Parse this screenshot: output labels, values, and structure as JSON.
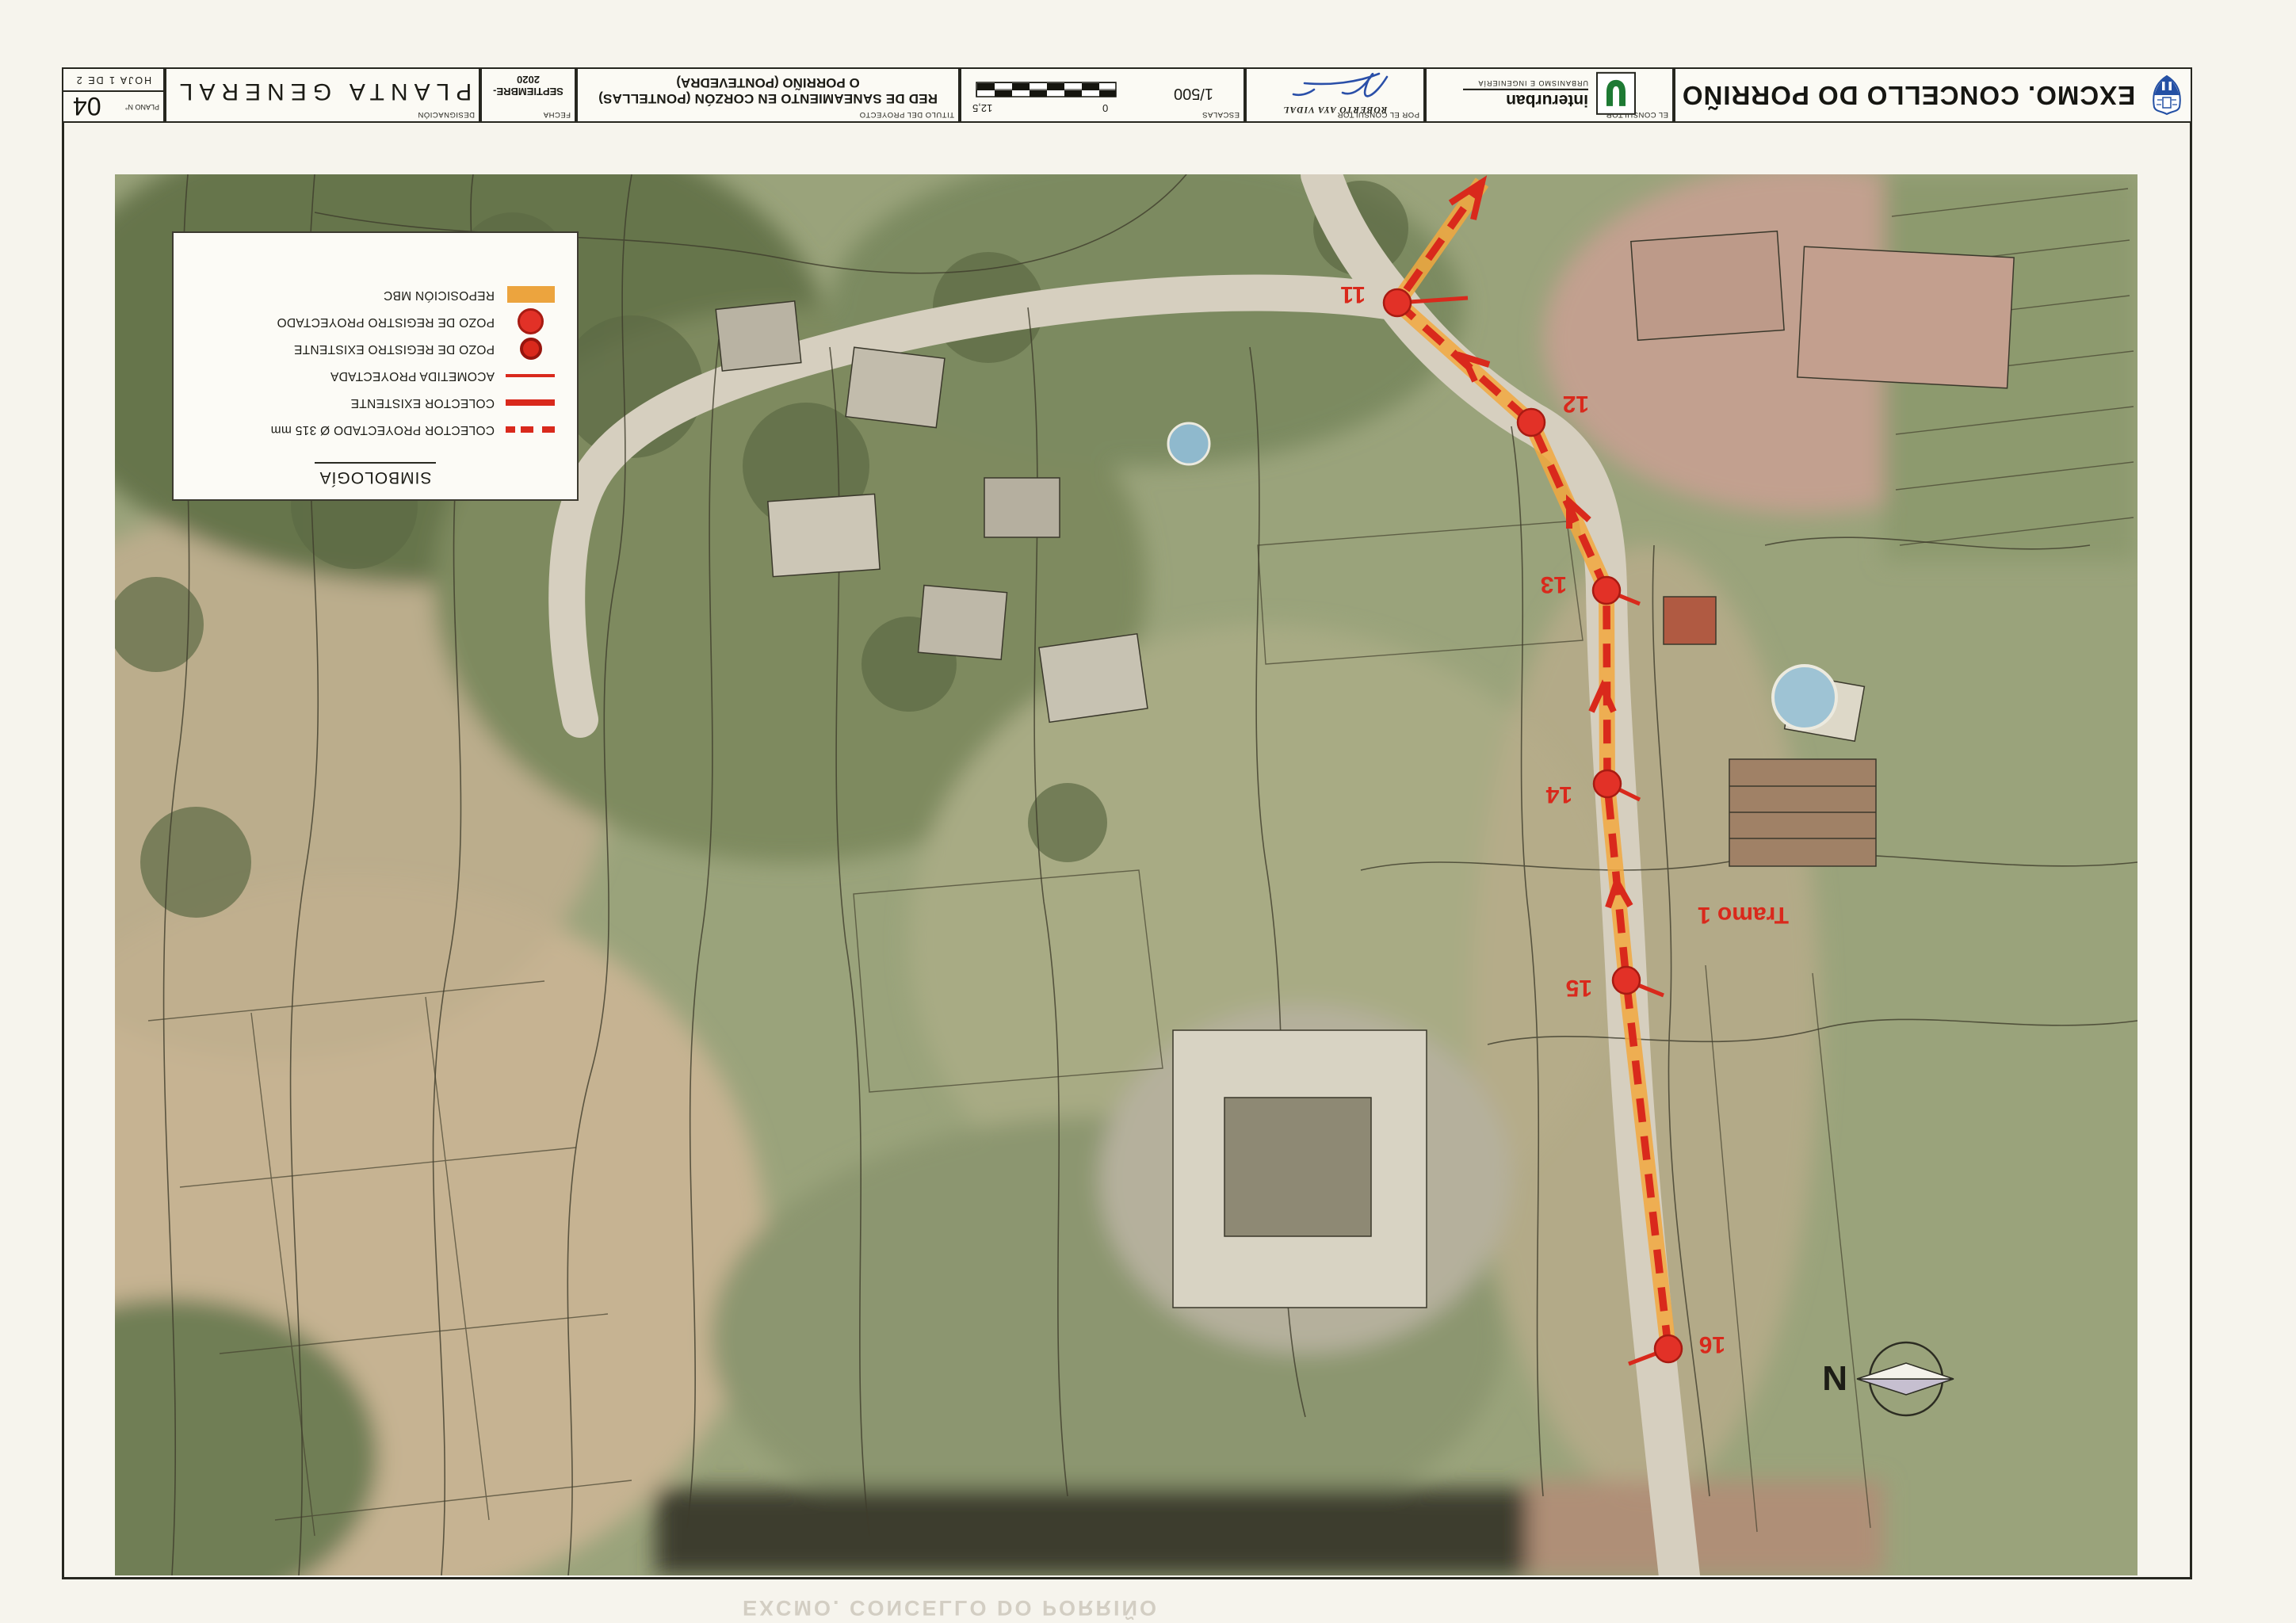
{
  "title_block": {
    "excmo": {
      "name": "EXCMO. CONCELLO DO PORRIÑO"
    },
    "consultor": {
      "label": "EL CONSULTOR",
      "brand": "interurban",
      "tagline": "URBANISMO E INGENIERÍA"
    },
    "por_consultor": {
      "label": "POR EL CONSULTOR",
      "name": "ROBERTO AYA VIDAL"
    },
    "escalas": {
      "label": "ESCALAS",
      "value": "1/500",
      "tick_zero": "0",
      "tick_max": "12,5"
    },
    "proyecto": {
      "label": "TITULO DEL PROYECTO",
      "line1": "RED DE SANEAMIENTO EN CORZÓN (PONTELLAS)",
      "line2": "O PORRIÑO (PONTEVEDRA)"
    },
    "fecha": {
      "label": "FECHA",
      "value": "SEPTIEMBRE-2020"
    },
    "designacion": {
      "label": "DESIGNACIÓN",
      "value": "PLANTA GENERAL"
    },
    "plano": {
      "label": "PLANO N°",
      "number": "04",
      "hoja": "HOJA 1 DE 2"
    }
  },
  "legend": {
    "title": "SIMBOLOGÍA",
    "items": [
      {
        "label": "COLECTOR PROYECTADO Ø 315 mm",
        "symbol": "dashed-red-line"
      },
      {
        "label": "COLECTOR EXISTENTE",
        "symbol": "solid-red-line-thick"
      },
      {
        "label": "ACOMETIDA PROYECTADA",
        "symbol": "solid-red-line-thin"
      },
      {
        "label": "POZO DE REGISTRO EXISTENTE",
        "symbol": "red-circle-small"
      },
      {
        "label": "POZO DE REGISTRO PROYECTADO",
        "symbol": "red-circle-large"
      },
      {
        "label": "REPOSICIÓN MBC",
        "symbol": "orange-rect"
      }
    ]
  },
  "map": {
    "nodes": [
      {
        "label": "11"
      },
      {
        "label": "12"
      },
      {
        "label": "13"
      },
      {
        "label": "14"
      },
      {
        "label": "15"
      },
      {
        "label": "16"
      }
    ],
    "tramo_label": "Tramo 1",
    "north_label": "N"
  },
  "ghost_text": "EXCMO. CONCELLO DO PORRIÑO",
  "colors": {
    "route_red": "#d9291c",
    "mbc_orange": "#f0a23c",
    "shield_blue": "#2450a4",
    "logo_green": "#1e7a34",
    "signature_blue": "#2a4fa8"
  }
}
